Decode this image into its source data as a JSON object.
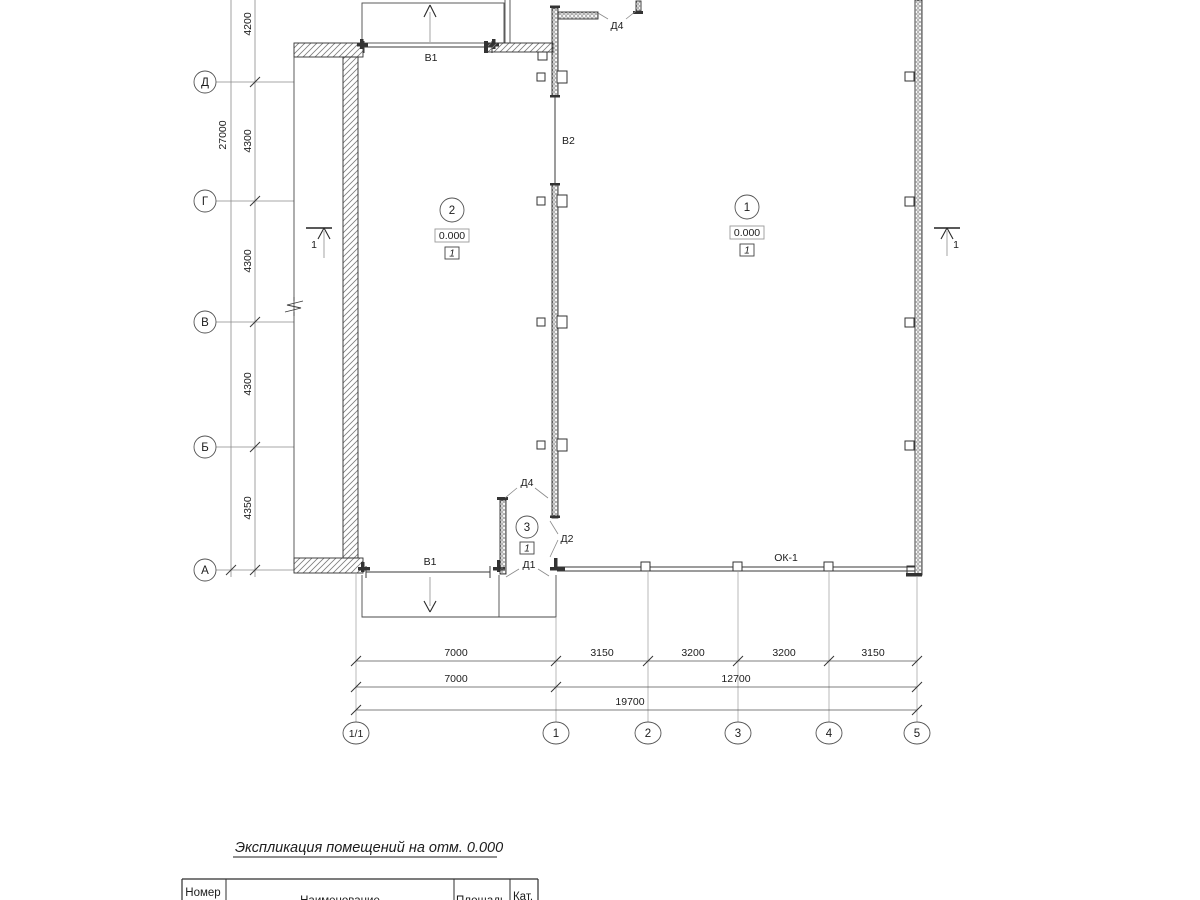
{
  "drawing": {
    "left_axes": {
      "bubbles": [
        "Д",
        "Г",
        "В",
        "Б",
        "А"
      ],
      "segment_dims": [
        "4200",
        "4300",
        "4300",
        "4300",
        "4350"
      ],
      "total_dim": "27000"
    },
    "bottom_axes": {
      "bubbles": [
        "1/1",
        "1",
        "2",
        "3",
        "4",
        "5"
      ],
      "dims_row1": [
        "7000",
        "3150",
        "3200",
        "3200",
        "3150"
      ],
      "dims_row2": [
        "7000",
        "12700"
      ],
      "dims_row3": "19700"
    },
    "rooms": [
      {
        "number": "2",
        "elevation": "0.000",
        "category": "1"
      },
      {
        "number": "1",
        "elevation": "0.000",
        "category": "1"
      },
      {
        "number": "3",
        "category": "1"
      }
    ],
    "labels": {
      "v1_top": "В1",
      "v1_bottom": "В1",
      "v2": "В2",
      "d4_top": "Д4",
      "d4_bottom": "Д4",
      "d2": "Д2",
      "d1": "Д1",
      "ok1": "ОК-1",
      "section_left": "1",
      "section_right": "1"
    }
  },
  "table": {
    "title": "Экспликация помещений на отм. 0.000",
    "headers": [
      "Номер",
      "Наименование",
      "Площадь",
      "Кат."
    ]
  }
}
